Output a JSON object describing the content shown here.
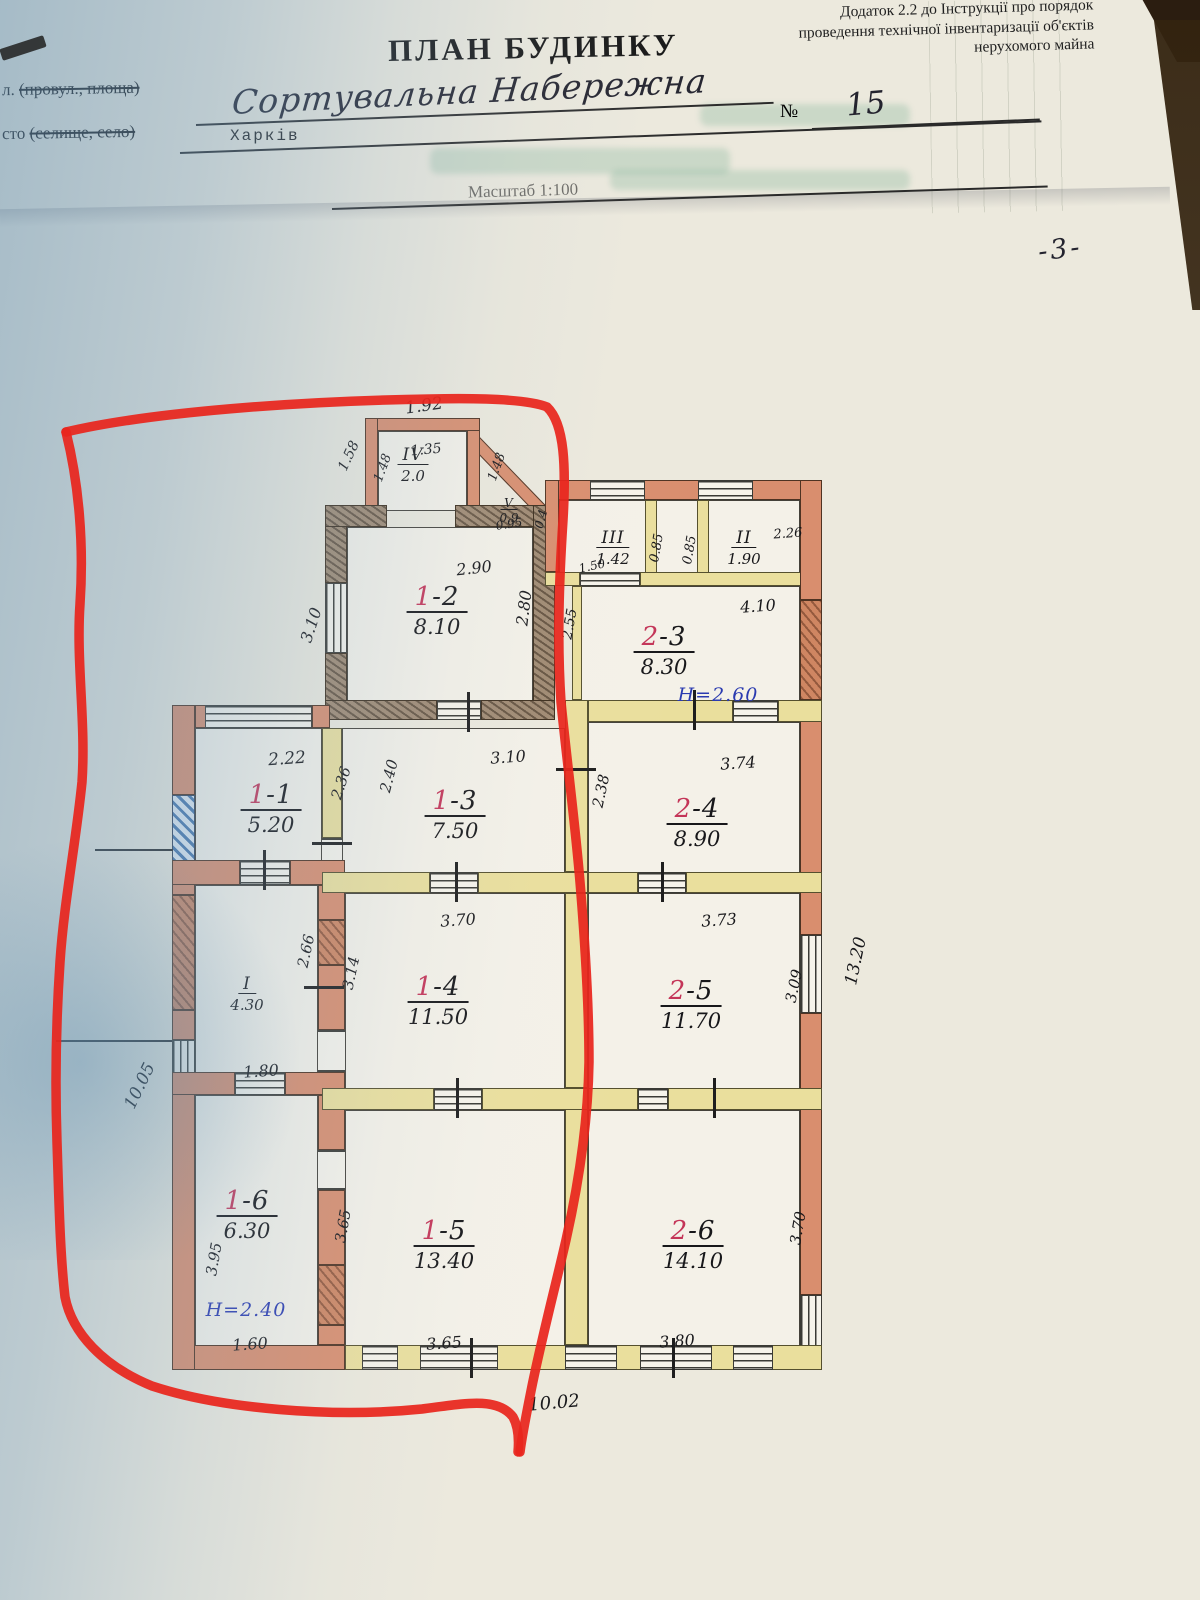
{
  "doc": {
    "appendix_lines": [
      "Додаток 2.2 до Інструкції про порядок",
      "проведення технічної інвентаризації об'єктів",
      "нерухомого майна"
    ],
    "title": "ПЛАН БУДИНКУ",
    "street_label_prefix": "л.",
    "street_label_paren": "(провул., площа)",
    "street_value": "Сортувальна Набережна",
    "number_sign": "№",
    "number_value": "15",
    "city_label_prefix": "сто",
    "city_label_paren": "(селище, село)",
    "city_value": "Харків",
    "scale_text": "Масштаб 1:100",
    "page_number": "-3-"
  },
  "plan": {
    "marker_color": "#e8261d",
    "fixture_color": "#16267d",
    "rooms": [
      {
        "id_red": "",
        "id_black": "IV",
        "area": "2.0",
        "x": 413,
        "y": 445,
        "s": 1
      },
      {
        "id_red": "",
        "id_black": "V",
        "area": "0.9",
        "x": 509,
        "y": 492,
        "s": 2
      },
      {
        "id_red": "",
        "id_black": "III",
        "area": "1.42",
        "x": 613,
        "y": 528,
        "s": 1
      },
      {
        "id_red": "",
        "id_black": "II",
        "area": "1.90",
        "x": 744,
        "y": 528,
        "s": 1
      },
      {
        "id_red": "1",
        "id_black": "-2",
        "area": "8.10",
        "x": 437,
        "y": 584
      },
      {
        "id_red": "2",
        "id_black": "-3",
        "area": "8.30",
        "x": 664,
        "y": 624
      },
      {
        "id_red": "1",
        "id_black": "-1",
        "area": "5.20",
        "x": 271,
        "y": 782
      },
      {
        "id_red": "1",
        "id_black": "-3",
        "area": "7.50",
        "x": 455,
        "y": 788
      },
      {
        "id_red": "2",
        "id_black": "-4",
        "area": "8.90",
        "x": 697,
        "y": 796
      },
      {
        "id_red": "",
        "id_black": "I",
        "area": "4.30",
        "x": 247,
        "y": 974,
        "s": 1
      },
      {
        "id_red": "1",
        "id_black": "-4",
        "area": "11.50",
        "x": 438,
        "y": 974
      },
      {
        "id_red": "2",
        "id_black": "-5",
        "area": "11.70",
        "x": 691,
        "y": 978
      },
      {
        "id_red": "1",
        "id_black": "-6",
        "area": "6.30",
        "x": 247,
        "y": 1188
      },
      {
        "id_red": "1",
        "id_black": "-5",
        "area": "13.40",
        "x": 444,
        "y": 1218
      },
      {
        "id_red": "2",
        "id_black": "-6",
        "area": "14.10",
        "x": 693,
        "y": 1218
      }
    ],
    "dims": [
      {
        "t": "1.92",
        "x": 424,
        "y": 406,
        "r": -8,
        "f": 17
      },
      {
        "t": "1.58",
        "x": 349,
        "y": 456,
        "r": -65,
        "f": 14
      },
      {
        "t": "1.48",
        "x": 383,
        "y": 468,
        "r": -70,
        "f": 13
      },
      {
        "t": "1.35",
        "x": 426,
        "y": 450,
        "r": -5,
        "f": 14
      },
      {
        "t": "1.48",
        "x": 497,
        "y": 467,
        "r": -70,
        "f": 13
      },
      {
        "t": "0.95",
        "x": 509,
        "y": 524,
        "r": -8,
        "f": 12
      },
      {
        "t": "0.4",
        "x": 541,
        "y": 519,
        "r": -75,
        "f": 12
      },
      {
        "t": "2.90",
        "x": 474,
        "y": 568,
        "r": -6,
        "f": 16
      },
      {
        "t": "2.80",
        "x": 524,
        "y": 608,
        "r": -83,
        "f": 16
      },
      {
        "t": "3.10",
        "x": 311,
        "y": 625,
        "r": -72,
        "f": 16
      },
      {
        "t": "2.55",
        "x": 570,
        "y": 624,
        "r": -80,
        "f": 14
      },
      {
        "t": "1.50",
        "x": 592,
        "y": 566,
        "r": -12,
        "f": 12
      },
      {
        "t": "0.85",
        "x": 657,
        "y": 548,
        "r": -80,
        "f": 13
      },
      {
        "t": "0.85",
        "x": 690,
        "y": 550,
        "r": -80,
        "f": 13
      },
      {
        "t": "2.26",
        "x": 788,
        "y": 534,
        "r": -4,
        "f": 13
      },
      {
        "t": "4.10",
        "x": 758,
        "y": 606,
        "r": -4,
        "f": 16
      },
      {
        "t": "2.22",
        "x": 287,
        "y": 759,
        "r": -4,
        "f": 17
      },
      {
        "t": "2.36",
        "x": 341,
        "y": 783,
        "r": -72,
        "f": 15
      },
      {
        "t": "2.40",
        "x": 389,
        "y": 776,
        "r": -76,
        "f": 15
      },
      {
        "t": "3.10",
        "x": 508,
        "y": 757,
        "r": -4,
        "f": 16
      },
      {
        "t": "2.38",
        "x": 601,
        "y": 791,
        "r": -78,
        "f": 15
      },
      {
        "t": "3.74",
        "x": 738,
        "y": 763,
        "r": -4,
        "f": 16
      },
      {
        "t": "2.66",
        "x": 306,
        "y": 951,
        "r": -78,
        "f": 15
      },
      {
        "t": "3.14",
        "x": 351,
        "y": 973,
        "r": -78,
        "f": 15
      },
      {
        "t": "3.70",
        "x": 458,
        "y": 920,
        "r": -4,
        "f": 16
      },
      {
        "t": "3.73",
        "x": 719,
        "y": 920,
        "r": -4,
        "f": 16
      },
      {
        "t": "3.09",
        "x": 794,
        "y": 986,
        "r": -78,
        "f": 15
      },
      {
        "t": "13.20",
        "x": 856,
        "y": 961,
        "r": -78,
        "f": 17
      },
      {
        "t": "1.80",
        "x": 261,
        "y": 1071,
        "r": -4,
        "f": 16
      },
      {
        "t": "10.05",
        "x": 140,
        "y": 1086,
        "r": -64,
        "f": 17
      },
      {
        "t": "3.95",
        "x": 214,
        "y": 1259,
        "r": -80,
        "f": 15
      },
      {
        "t": "3.65",
        "x": 343,
        "y": 1226,
        "r": -80,
        "f": 15
      },
      {
        "t": "1.60",
        "x": 250,
        "y": 1344,
        "r": -4,
        "f": 16
      },
      {
        "t": "3.65",
        "x": 444,
        "y": 1343,
        "r": -4,
        "f": 16
      },
      {
        "t": "3.80",
        "x": 677,
        "y": 1341,
        "r": -4,
        "f": 16
      },
      {
        "t": "3.70",
        "x": 798,
        "y": 1228,
        "r": -80,
        "f": 15
      },
      {
        "t": "10.02",
        "x": 554,
        "y": 1403,
        "r": -5,
        "f": 18
      }
    ],
    "heights": [
      {
        "t": "Н=2.60",
        "x": 718,
        "y": 695
      },
      {
        "t": "Н=2.40",
        "x": 246,
        "y": 1310
      }
    ]
  }
}
